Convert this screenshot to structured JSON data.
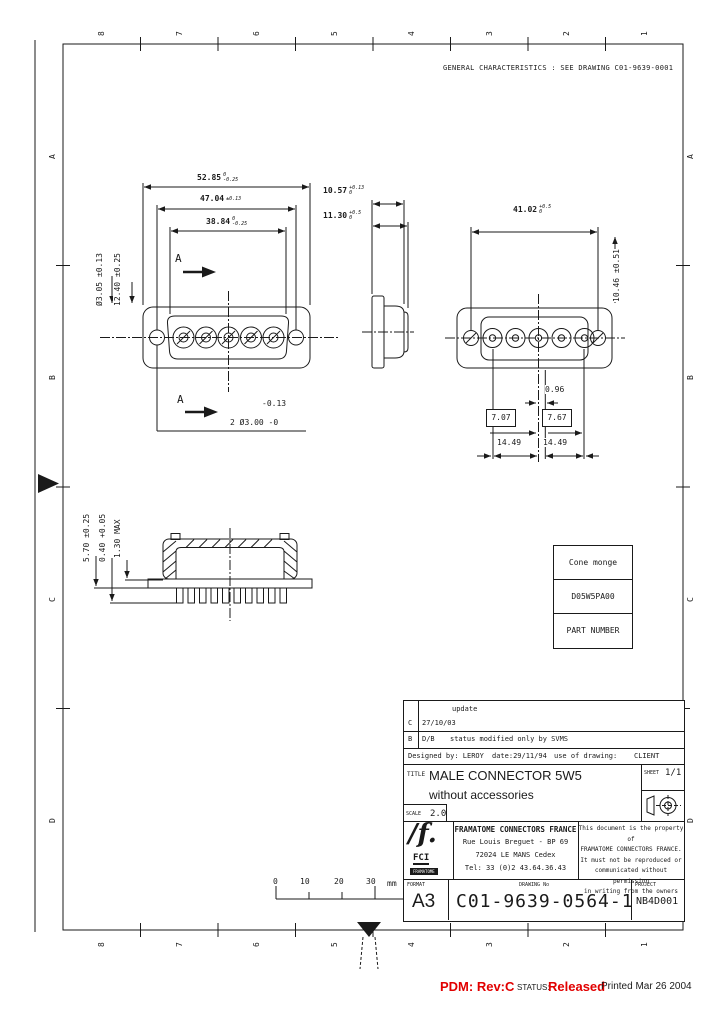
{
  "frame": {
    "cols": [
      "8",
      "7",
      "6",
      "5",
      "4",
      "3",
      "2",
      "1"
    ],
    "rows": [
      "A",
      "B",
      "C",
      "D"
    ]
  },
  "note": "GENERAL CHARACTERISTICS : SEE DRAWING C01-9639-0001",
  "front": {
    "dim1v": "52.85",
    "dim1t": "0",
    "dim1b": "-0.25",
    "dim2v": "47.04",
    "dim2t": "±0.13",
    "dim2b": "",
    "dim3v": "38.84",
    "dim3t": "0",
    "dim3b": "-0.25",
    "left1": "Ø3.05 ±0.13",
    "left2": "12.40 ±0.25",
    "hole_tol": "-0.13",
    "hole_callout": "2 Ø3.00 -0",
    "section": "A"
  },
  "side": {
    "dim1v": "10.57",
    "dim1t": "+0.13",
    "dim1b": "0",
    "dim2v": "11.30",
    "dim2t": "+0.5",
    "dim2b": "0"
  },
  "rear": {
    "topv": "41.02",
    "topt": "+0.5",
    "topb": "0",
    "right": "10.46 ±0.51",
    "d096": "0.96",
    "b1": "7.07",
    "b2": "7.67",
    "d14a": "14.49",
    "d14b": "14.49"
  },
  "section_view": {
    "left1": "5.70 ±0.25",
    "left2": "0.40 +0.05",
    "left3": "1.30 MAX"
  },
  "part_table": {
    "r1": "Cone monge",
    "r2": "D05W5PA00",
    "r3": "PART NUMBER"
  },
  "ruler": {
    "l0": "0",
    "l1": "10",
    "l2": "20",
    "l3": "30",
    "unit": "mm"
  },
  "tb": {
    "rev1_desc": "update",
    "rev1_rev": "C",
    "rev1_date": "27/10/03",
    "rev2_rev": "B",
    "rev2_date": "D/B",
    "rev2_desc": "status modified only by SVMS",
    "designed": "Designed by: LEROY",
    "date": "date:29/11/94",
    "use_label": "use of drawing:",
    "use_value": "CLIENT",
    "title_label": "TITLE",
    "title1": "MALE CONNECTOR 5W5",
    "title2": "without accessories",
    "scale_label": "SCALE",
    "scale": "2.0",
    "sheet_label": "SHEET",
    "sheet": "1/1",
    "company_name": "FRAMATOME CONNECTORS FRANCE",
    "addr1": "Rue Louis Breguet - BP 69",
    "addr2": "72024 LE MANS Cedex",
    "addr3": "Tel: 33 (0)2 43.64.36.43",
    "logo_glyph": "∕f.",
    "logo_name": "FCI",
    "logo_group": "FRAMATOME",
    "prop1": "This document is the property of",
    "prop2": "FRAMATOME CONNECTORS FRANCE.",
    "prop3": "It must not be reproduced or",
    "prop4": "communicated without permission",
    "prop5": "in writing from the owners",
    "format_label": "FORMAT",
    "format": "A3",
    "number_label": "DRAWING No",
    "number": "C01-9639-0564-1",
    "project_label": "PROJECT",
    "project": "NB4D001"
  },
  "statusbar": {
    "pdm": "PDM: Rev:C",
    "status_label": "STATUS:",
    "status": "Released",
    "printed": "Printed Mar 26 2004"
  },
  "colors": {
    "red": "#e10000",
    "ink": "#1a1a1a"
  }
}
